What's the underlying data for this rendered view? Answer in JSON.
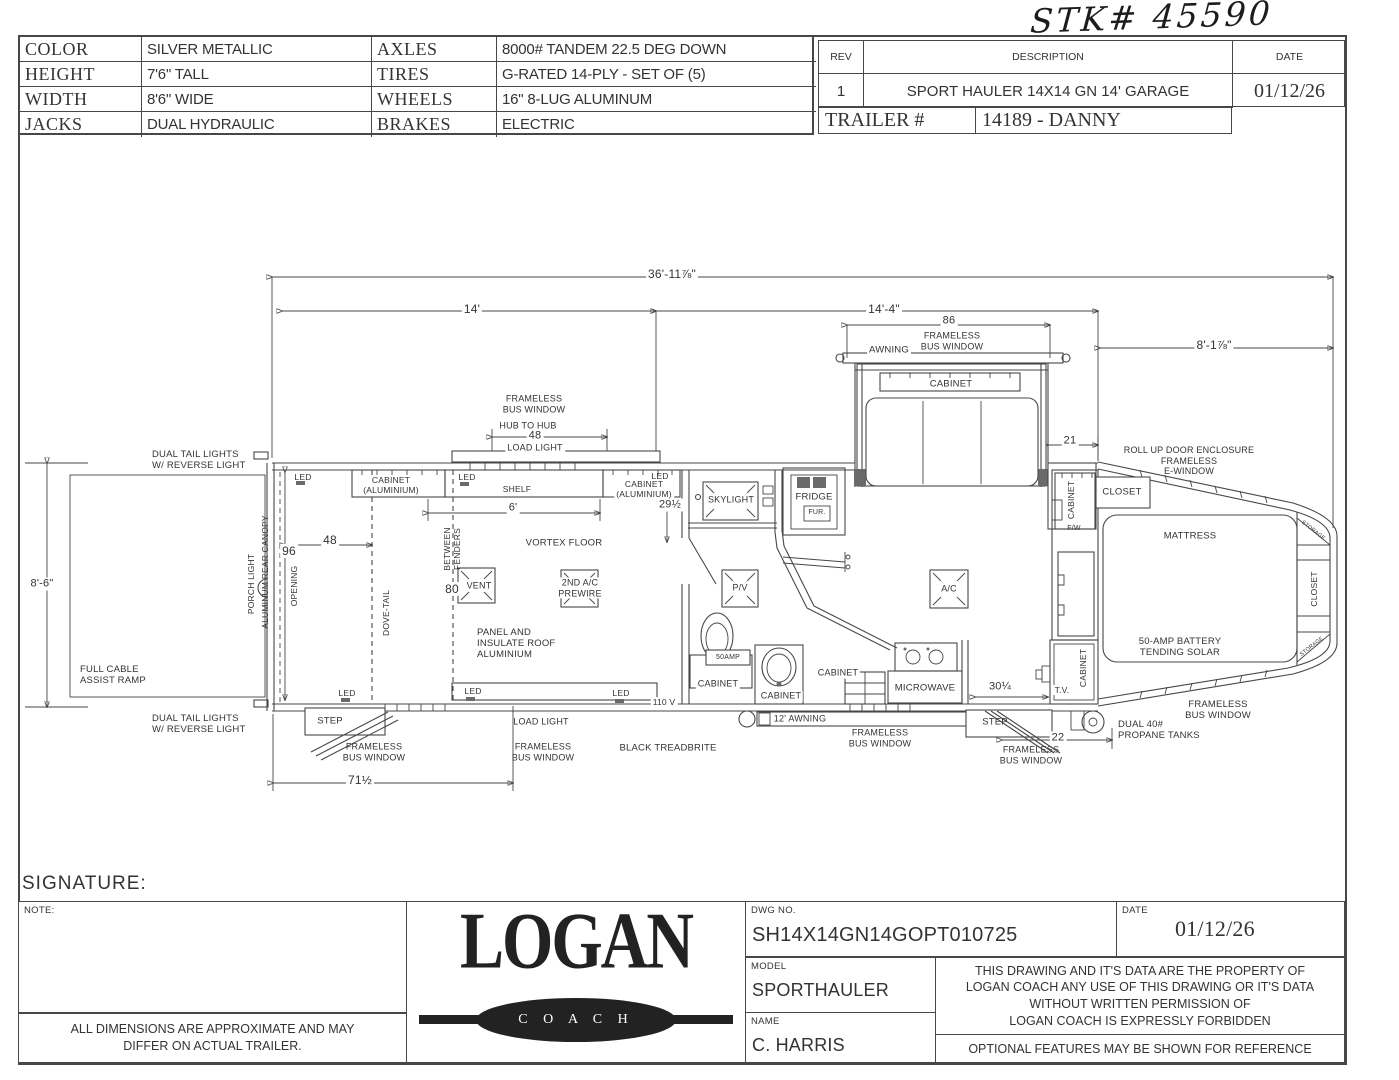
{
  "handwritten_stock_number": "STK# 45590",
  "spec_table": {
    "rows": [
      {
        "label_left": "COLOR",
        "value_left": "SILVER METALLIC",
        "label_right": "AXLES",
        "value_right": "8000# TANDEM 22.5 DEG DOWN"
      },
      {
        "label_left": "HEIGHT",
        "value_left": "7'6\" TALL",
        "label_right": "TIRES",
        "value_right": "G-RATED  14-PLY - SET OF (5)"
      },
      {
        "label_left": "WIDTH",
        "value_left": "8'6\" WIDE",
        "label_right": "WHEELS",
        "value_right": "16\" 8-LUG ALUMINUM"
      },
      {
        "label_left": "JACKS",
        "value_left": "DUAL HYDRAULIC",
        "label_right": "BRAKES",
        "value_right": "ELECTRIC"
      }
    ]
  },
  "revision_table": {
    "headers": {
      "rev": "REV",
      "description": "DESCRIPTION",
      "date": "DATE"
    },
    "row": {
      "rev": "1",
      "description": "SPORT HAULER 14X14 GN 14' GARAGE",
      "date": "01/12/26"
    },
    "trailer_label": "TRAILER #",
    "trailer_number": "14189 - DANNY"
  },
  "signature_label": "SIGNATURE:",
  "note_label": "NOTE:",
  "disclaimer": "ALL DIMENSIONS ARE APPROXIMATE AND MAY\nDIFFER ON ACTUAL TRAILER.",
  "logo": {
    "name": "LOGAN",
    "sub": "C O A C H"
  },
  "title_block": {
    "dwg_label": "DWG  NO.",
    "dwg_no": "SH14X14GN14GOPT010725",
    "date_label": "DATE",
    "date": "01/12/26",
    "model_label": "MODEL",
    "model": "SPORTHAULER",
    "name_label": "NAME",
    "name": "C. HARRIS",
    "legal": "THIS DRAWING AND IT'S DATA ARE THE PROPERTY OF\nLOGAN COACH ANY USE OF THIS DRAWING OR IT'S DATA\nWITHOUT WRITTEN PERMISSION OF\nLOGAN COACH IS EXPRESSLY FORBIDDEN",
    "optional_note": "OPTIONAL FEATURES MAY BE SHOWN FOR REFERENCE"
  },
  "plan_labels": [
    {
      "n": "dim-overall-length",
      "t": "36'-11⅞\"",
      "x": 672,
      "y": 274,
      "fs": 12,
      "bg": 1
    },
    {
      "n": "dim-garage-length",
      "t": "14'",
      "x": 472,
      "y": 309,
      "fs": 12,
      "bg": 1
    },
    {
      "n": "dim-living-length",
      "t": "14'-4\"",
      "x": 884,
      "y": 309,
      "fs": 12,
      "bg": 1
    },
    {
      "n": "dim-gooseneck-length",
      "t": "8'-1⅞\"",
      "x": 1214,
      "y": 345,
      "fs": 12,
      "bg": 1
    },
    {
      "n": "dim-slide-window-86",
      "t": "86",
      "x": 949,
      "y": 321,
      "fs": 11,
      "bg": 1
    },
    {
      "n": "label-frameless-bus-window-slide",
      "t": "FRAMELESS\nBUS WINDOW",
      "x": 952,
      "y": 341,
      "fs": 9
    },
    {
      "n": "label-awning-slide",
      "t": "AWNING",
      "x": 889,
      "y": 350,
      "fs": 9.5,
      "bg": 1
    },
    {
      "n": "label-cabinet-slide",
      "t": "CABINET",
      "x": 951,
      "y": 384,
      "fs": 9.5,
      "bg": 1
    },
    {
      "n": "dim-rollup-enclosure-21",
      "t": "21",
      "x": 1070,
      "y": 441,
      "fs": 11,
      "bg": 1
    },
    {
      "n": "label-rollup-enclosure",
      "t": "ROLL UP DOOR ENCLOSURE\nFRAMELESS\nE-WINDOW",
      "x": 1189,
      "y": 461,
      "fs": 9
    },
    {
      "n": "label-frameless-bus-window-garage-top",
      "t": "FRAMELESS\nBUS WINDOW",
      "x": 534,
      "y": 404,
      "fs": 9
    },
    {
      "n": "label-hub-to-hub",
      "t": "HUB TO HUB",
      "x": 528,
      "y": 426,
      "fs": 9
    },
    {
      "n": "dim-hub-to-hub-48",
      "t": "48",
      "x": 535,
      "y": 436,
      "fs": 11,
      "bg": 1
    },
    {
      "n": "label-load-light-top",
      "t": "LOAD LIGHT",
      "x": 535,
      "y": 448,
      "fs": 9,
      "bg": 1
    },
    {
      "n": "label-dual-tail-lights-top",
      "t": "DUAL TAIL LIGHTS\nW/ REVERSE LIGHT",
      "x": 152,
      "y": 460,
      "fs": 9.5,
      "ta": "left"
    },
    {
      "n": "label-dual-tail-lights-bottom",
      "t": "DUAL TAIL LIGHTS\nW/ REVERSE LIGHT",
      "x": 152,
      "y": 724,
      "fs": 9.5,
      "ta": "left"
    },
    {
      "n": "dim-rear-height",
      "t": "8'-6\"",
      "x": 42,
      "y": 584,
      "fs": 11,
      "bg": 1
    },
    {
      "n": "label-full-cable-ramp",
      "t": "FULL CABLE\nASSIST RAMP",
      "x": 80,
      "y": 675,
      "fs": 9.5,
      "ta": "left"
    },
    {
      "n": "label-porch-light",
      "t": "PORCH LIGHT",
      "x": 251,
      "y": 584,
      "fs": 8.5,
      "r": -90
    },
    {
      "n": "label-aluminum-rear-canopy",
      "t": "ALUMINUM REAR CANOPY",
      "x": 265,
      "y": 572,
      "fs": 8.5,
      "r": -90
    },
    {
      "n": "dim-rear-opening-96",
      "t": "96",
      "x": 289,
      "y": 551,
      "fs": 12,
      "bg": 1
    },
    {
      "n": "label-opening",
      "t": "OPENING",
      "x": 294,
      "y": 586,
      "fs": 8.5,
      "r": -90
    },
    {
      "n": "label-led-garage-top-left",
      "t": "LED",
      "x": 303,
      "y": 477,
      "fs": 8.5
    },
    {
      "n": "label-cabinet-aluminium-left",
      "t": "CABINET\n(ALUMINIUM)",
      "x": 391,
      "y": 485,
      "fs": 8.5,
      "bg": 1
    },
    {
      "n": "label-led-shelf",
      "t": "LED",
      "x": 467,
      "y": 477,
      "fs": 8.5
    },
    {
      "n": "label-shelf",
      "t": "SHELF",
      "x": 517,
      "y": 489,
      "fs": 8.5,
      "bg": 1
    },
    {
      "n": "label-cabinet-aluminium-right",
      "t": "CABINET\n(ALUMINIUM)",
      "x": 644,
      "y": 489,
      "fs": 8.5,
      "bg": 1
    },
    {
      "n": "label-led-garage-top-right",
      "t": "LED",
      "x": 660,
      "y": 476,
      "fs": 8.5
    },
    {
      "n": "dim-29-half",
      "t": "29½",
      "x": 670,
      "y": 505,
      "fs": 11,
      "bg": 1
    },
    {
      "n": "dim-shelf-6ft",
      "t": "6'",
      "x": 513,
      "y": 508,
      "fs": 11,
      "bg": 1
    },
    {
      "n": "dim-dovetail-48",
      "t": "48",
      "x": 330,
      "y": 540,
      "fs": 12,
      "bg": 1
    },
    {
      "n": "label-dove-tail",
      "t": "DOVE-TAIL",
      "x": 386,
      "y": 613,
      "fs": 8.5,
      "r": -90
    },
    {
      "n": "label-between-fenders",
      "t": "BETWEEN\nFENDERS",
      "x": 452,
      "y": 549,
      "fs": 8.5,
      "r": -90
    },
    {
      "n": "dim-between-fenders-80",
      "t": "80",
      "x": 452,
      "y": 589,
      "fs": 12,
      "bg": 1
    },
    {
      "n": "label-vent",
      "t": "VENT",
      "x": 479,
      "y": 586,
      "fs": 9,
      "bg": 1
    },
    {
      "n": "label-vortex-floor",
      "t": "VORTEX FLOOR",
      "x": 564,
      "y": 543,
      "fs": 9.5
    },
    {
      "n": "label-2nd-ac-prewire",
      "t": "2ND A/C\nPREWIRE",
      "x": 580,
      "y": 588,
      "fs": 9,
      "bg": 1
    },
    {
      "n": "label-panel-insulate-roof",
      "t": "PANEL AND\nINSULATE ROOF\nALUMINIUM",
      "x": 477,
      "y": 644,
      "fs": 9.5,
      "ta": "left"
    },
    {
      "n": "label-led-bottom-1",
      "t": "LED",
      "x": 347,
      "y": 693,
      "fs": 8.5
    },
    {
      "n": "label-led-bottom-2",
      "t": "LED",
      "x": 473,
      "y": 691,
      "fs": 8.5
    },
    {
      "n": "label-led-bottom-3",
      "t": "LED",
      "x": 621,
      "y": 693,
      "fs": 8.5
    },
    {
      "n": "label-110v",
      "t": "110 V",
      "x": 664,
      "y": 702,
      "fs": 8.5,
      "bg": 1
    },
    {
      "n": "label-step-left",
      "t": "STEP",
      "x": 330,
      "y": 721,
      "fs": 9.5
    },
    {
      "n": "label-frameless-bus-window-rear-bottom",
      "t": "FRAMELESS\nBUS WINDOW",
      "x": 374,
      "y": 752,
      "fs": 9
    },
    {
      "n": "dim-71-half",
      "t": "71½",
      "x": 360,
      "y": 780,
      "fs": 12,
      "bg": 1
    },
    {
      "n": "label-load-light-bottom",
      "t": "LOAD LIGHT",
      "x": 541,
      "y": 722,
      "fs": 9
    },
    {
      "n": "label-frameless-bus-window-garage-bottom",
      "t": "FRAMELESS\nBUS WINDOW",
      "x": 543,
      "y": 752,
      "fs": 9
    },
    {
      "n": "label-black-treadbrite",
      "t": "BLACK TREADBRITE",
      "x": 668,
      "y": 748,
      "fs": 9.5
    },
    {
      "n": "label-skylight",
      "t": "SKYLIGHT",
      "x": 731,
      "y": 500,
      "fs": 9,
      "bg": 1
    },
    {
      "n": "label-fridge",
      "t": "FRIDGE",
      "x": 814,
      "y": 497,
      "fs": 9.5,
      "bg": 1
    },
    {
      "n": "label-fur",
      "t": "FUR.",
      "x": 817,
      "y": 513,
      "fs": 7
    },
    {
      "n": "label-pv",
      "t": "P/V",
      "x": 740,
      "y": 588,
      "fs": 9,
      "bg": 1
    },
    {
      "n": "label-50amp",
      "t": "50AMP",
      "x": 728,
      "y": 658,
      "fs": 7
    },
    {
      "n": "label-cabinet-bath",
      "t": "CABINET",
      "x": 718,
      "y": 684,
      "fs": 9,
      "bg": 1
    },
    {
      "n": "label-cabinet-sink",
      "t": "CABINET",
      "x": 781,
      "y": 696,
      "fs": 9,
      "bg": 1
    },
    {
      "n": "label-cabinet-kitchen",
      "t": "CABINET",
      "x": 838,
      "y": 673,
      "fs": 9,
      "bg": 1
    },
    {
      "n": "label-microwave",
      "t": "MICROWAVE",
      "x": 925,
      "y": 688,
      "fs": 9.5,
      "bg": 1
    },
    {
      "n": "label-ac",
      "t": "A/C",
      "x": 949,
      "y": 589,
      "fs": 9,
      "bg": 1
    },
    {
      "n": "label-12ft-awning",
      "t": "12' AWNING",
      "x": 800,
      "y": 719,
      "fs": 9,
      "bg": 1
    },
    {
      "n": "label-frameless-bus-window-mid",
      "t": "FRAMELESS\nBUS WINDOW",
      "x": 880,
      "y": 738,
      "fs": 9
    },
    {
      "n": "label-step-right",
      "t": "STEP",
      "x": 995,
      "y": 722,
      "fs": 9.5
    },
    {
      "n": "dim-30-quarter",
      "t": "30¼",
      "x": 1000,
      "y": 687,
      "fs": 11,
      "bg": 1
    },
    {
      "n": "dim-22",
      "t": "22",
      "x": 1058,
      "y": 738,
      "fs": 11,
      "bg": 1
    },
    {
      "n": "label-frameless-bus-window-right-bottom",
      "t": "FRAMELESS\nBUS WINDOW",
      "x": 1031,
      "y": 755,
      "fs": 9
    },
    {
      "n": "label-propane-tanks",
      "t": "DUAL 40#\nPROPANE TANKS",
      "x": 1118,
      "y": 730,
      "fs": 9.5,
      "ta": "left"
    },
    {
      "n": "label-tv",
      "t": "T.V.",
      "x": 1062,
      "y": 690,
      "fs": 8.5,
      "bg": 1
    },
    {
      "n": "label-cabinet-tv",
      "t": "CABINET",
      "x": 1083,
      "y": 668,
      "fs": 8.5,
      "r": -90
    },
    {
      "n": "label-cabinet-column",
      "t": "CABINET",
      "x": 1071,
      "y": 500,
      "fs": 8.5,
      "r": -90
    },
    {
      "n": "label-fw",
      "t": "F/W",
      "x": 1074,
      "y": 529,
      "fs": 7
    },
    {
      "n": "label-closet-top",
      "t": "CLOSET",
      "x": 1122,
      "y": 492,
      "fs": 9.5
    },
    {
      "n": "label-mattress",
      "t": "MATTRESS",
      "x": 1190,
      "y": 536,
      "fs": 9.5
    },
    {
      "n": "label-50amp-battery-solar",
      "t": "50-AMP BATTERY\nTENDING SOLAR",
      "x": 1180,
      "y": 647,
      "fs": 9.5
    },
    {
      "n": "label-closet-nose",
      "t": "CLOSET",
      "x": 1314,
      "y": 589,
      "fs": 8.5,
      "r": -90
    },
    {
      "n": "label-storage-top",
      "t": "STORAGE",
      "x": 1313,
      "y": 531,
      "fs": 5.5,
      "r": 38
    },
    {
      "n": "label-storage-bottom",
      "t": "STORAGE",
      "x": 1312,
      "y": 647,
      "fs": 5.5,
      "r": -38
    },
    {
      "n": "label-frameless-bus-window-nose",
      "t": "FRAMELESS\nBUS WINDOW",
      "x": 1218,
      "y": 710,
      "fs": 9.5
    }
  ]
}
